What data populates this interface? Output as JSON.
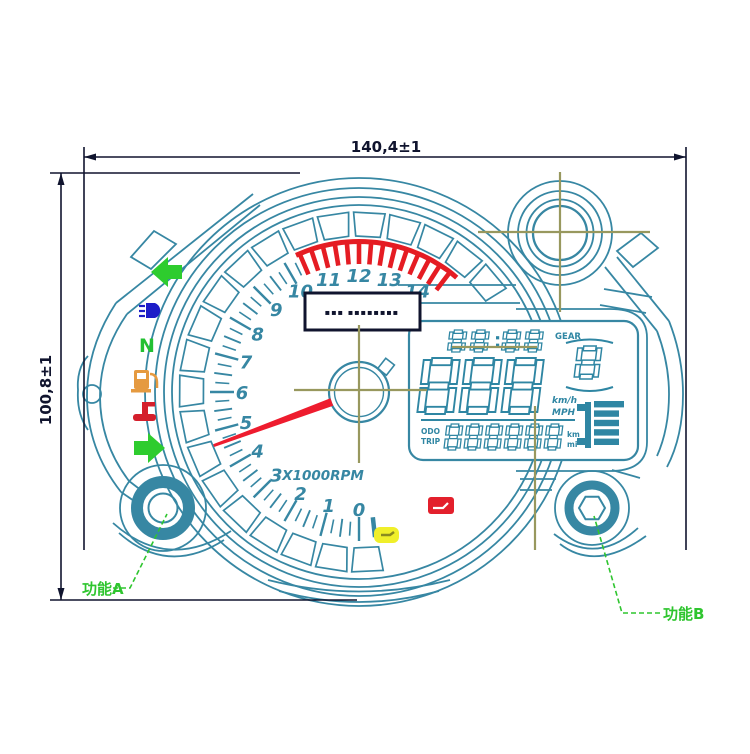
{
  "drawing_title": "motorcycle instrument cluster dimensional drawing",
  "dimensions": {
    "width_label": "140,4±1",
    "height_label": "100,8±1"
  },
  "callouts": {
    "function_a": "功能A",
    "function_b": "功能B"
  },
  "tachometer": {
    "unit_label": "X1000RPM",
    "scale_numbers": [
      0,
      1,
      2,
      3,
      4,
      5,
      6,
      7,
      8,
      9,
      10,
      11,
      12,
      13,
      14
    ],
    "scale_max": 14,
    "redline_from": 10.45,
    "redline_to": 14.75,
    "needle_value": 4.65,
    "label_box_text": "▪▪▪ ▪▪▪▪▪▪▪▪"
  },
  "indicators": [
    {
      "id": "turn-left",
      "label": "",
      "color": "#2ecc2e"
    },
    {
      "id": "high-beam",
      "label": "",
      "color": "#1d1dc8"
    },
    {
      "id": "neutral",
      "label": "N",
      "color": "#22c032"
    },
    {
      "id": "low-fuel",
      "label": "",
      "color": "#e59a40"
    },
    {
      "id": "oil-pressure",
      "label": "",
      "color": "#d41f2c"
    },
    {
      "id": "turn-right",
      "label": "",
      "color": "#2ecc2e"
    }
  ],
  "warning_lights": [
    {
      "id": "engine-warning",
      "color": "#f0ef2a"
    },
    {
      "id": "fuel-warning",
      "color": "#e3202c"
    }
  ],
  "lcd": {
    "clock": "88:88",
    "gear_label": "GEAR",
    "gear_value": "8",
    "speed_value": "888",
    "speed_unit_1": "km/h",
    "speed_unit_2": "MPH",
    "odo_label_1": "ODO",
    "odo_label_2": "TRIP",
    "odometer_value": "888888",
    "odo_unit_1": "km",
    "odo_unit_2": "mi",
    "fuel_bars": 5
  },
  "colors": {
    "line_teal": "#3787a3",
    "line_navy": "#10142e",
    "centerline_olive": "#98985e",
    "redline": "#e51c23",
    "needle": "#ee1c2e",
    "lcd_teal": "#2f86a3",
    "callout_green": "#2fc52f"
  }
}
